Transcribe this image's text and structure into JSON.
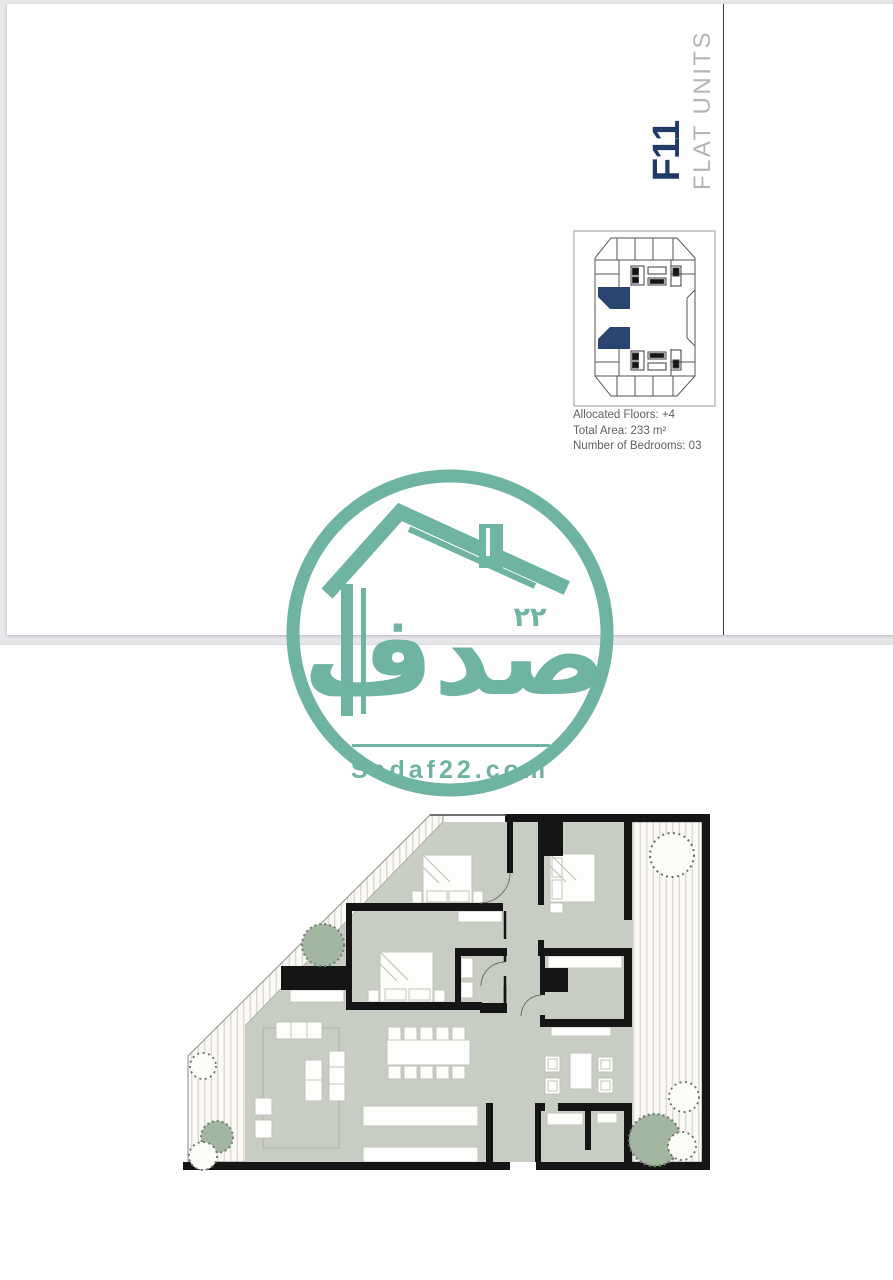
{
  "page": {
    "unit_code": "F11",
    "unit_type": "FLAT UNITS",
    "specs": {
      "floors": "Allocated Floors: +4",
      "area": "Total Area: 233 m²",
      "bedrooms": "Number of Bedrooms: 03"
    }
  },
  "watermark": {
    "arabic_name": "صدف",
    "arabic_number": "٢٢",
    "domain": "Sadaf22.com"
  },
  "colors": {
    "accent_navy": "#223a66",
    "title_gray": "#b5b5b7",
    "spec_text_gray": "#5d6065",
    "watermark_teal": "#6fb3a2",
    "floor_sage": "#c8cdc4",
    "terrace_stripe": "#d8d5ce",
    "tree_sage": "#a3b6a2",
    "wall_black": "#151515"
  }
}
